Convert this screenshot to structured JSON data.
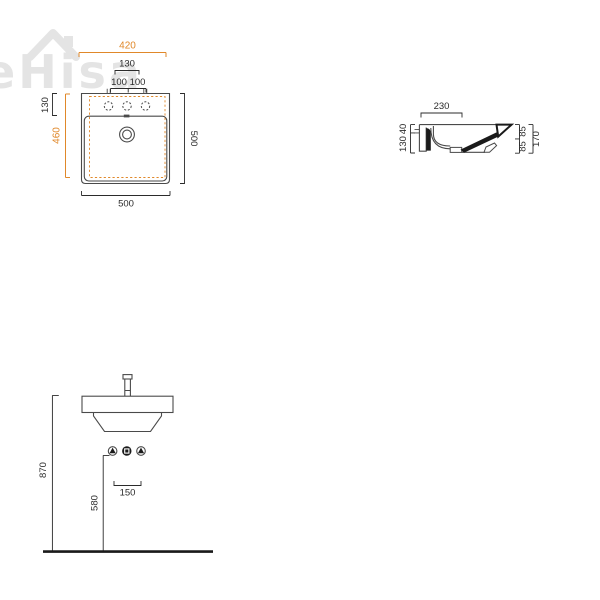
{
  "watermark": {
    "text": "eHisa",
    "icon": "house-roof-icon"
  },
  "colors": {
    "accent_orange": "#E0882A",
    "line": "#4a4a4a",
    "dim": "#2b2b2b",
    "section_fill": "#1a1a1a",
    "watermark": "#e4e4e4"
  },
  "top_view": {
    "dim_outer_width": "420",
    "dim_holes_span": "130",
    "dim_hole_spacing_left": "100",
    "dim_hole_spacing_right": "100",
    "dim_deck_depth": "130",
    "dim_inner_depth": "460",
    "dim_depth_total": "500",
    "dim_width_total": "500"
  },
  "side_view": {
    "dim_top_depth": "230",
    "dim_rim_height": "40",
    "dim_body_height": "130",
    "dim_back_upper": "85",
    "dim_back_lower": "85",
    "dim_height_total": "170"
  },
  "front_view": {
    "dim_floor_to_rim": "870",
    "dim_drain_height": "580",
    "dim_connection_spacing": "150",
    "connection_symbols": [
      {
        "icon": "water-connection-triangle-icon"
      },
      {
        "icon": "drain-connection-square-icon"
      },
      {
        "icon": "water-connection-triangle-icon"
      }
    ]
  }
}
